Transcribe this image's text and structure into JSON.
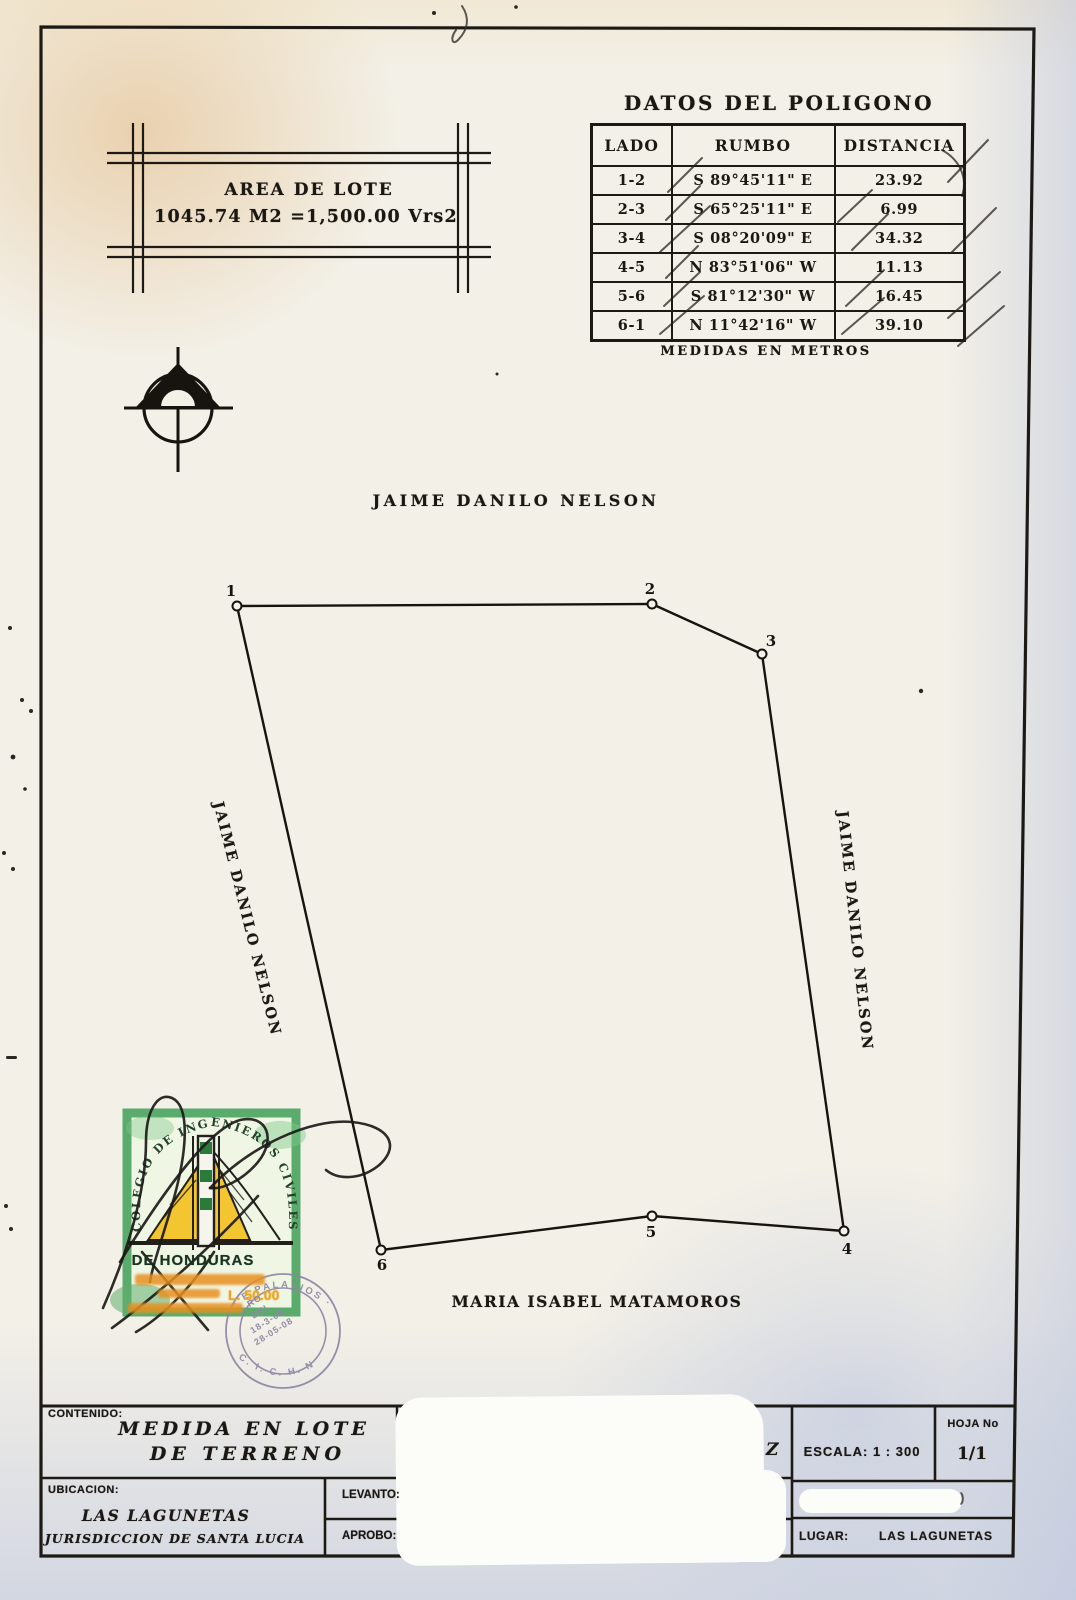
{
  "table": {
    "title": "DATOS DEL POLIGONO",
    "headers": [
      "LADO",
      "RUMBO",
      "DISTANCIA"
    ],
    "rows": [
      {
        "lado": "1-2",
        "rumbo": "S 89°45'11\" E",
        "distancia": "23.92"
      },
      {
        "lado": "2-3",
        "rumbo": "S 65°25'11\" E",
        "distancia": "6.99"
      },
      {
        "lado": "3-4",
        "rumbo": "S 08°20'09\" E",
        "distancia": "34.32"
      },
      {
        "lado": "4-5",
        "rumbo": "N 83°51'06\" W",
        "distancia": "11.13"
      },
      {
        "lado": "5-6",
        "rumbo": "S 81°12'30\" W",
        "distancia": "16.45"
      },
      {
        "lado": "6-1",
        "rumbo": "N 11°42'16\" W",
        "distancia": "39.10"
      }
    ],
    "footnote": "MEDIDAS EN METROS"
  },
  "area_box": {
    "line1": "AREA DE LOTE",
    "line2": "1045.74 M2 =1,500.00 Vrs2"
  },
  "plot": {
    "adjoiners": {
      "top": "JAIME DANILO NELSON",
      "left": "JAIME DANILO NELSON",
      "right": "JAIME DANILO NELSON",
      "bottom": "MARIA ISABEL MATAMOROS"
    },
    "vertices": [
      {
        "id": "1",
        "x": 237,
        "y": 606,
        "dx": -6,
        "dy": -10
      },
      {
        "id": "2",
        "x": 652,
        "y": 604,
        "dx": -2,
        "dy": -10
      },
      {
        "id": "3",
        "x": 762,
        "y": 654,
        "dx": 9,
        "dy": -8
      },
      {
        "id": "4",
        "x": 844,
        "y": 1231,
        "dx": 3,
        "dy": 23
      },
      {
        "id": "5",
        "x": 652,
        "y": 1216,
        "dx": -1,
        "dy": 21
      },
      {
        "id": "6",
        "x": 381,
        "y": 1250,
        "dx": 1,
        "dy": 20
      }
    ]
  },
  "stamp": {
    "arc_text": "COLEGIO DE INGENIEROS CIVILES",
    "line1": "DE HONDURAS",
    "value": "L. 50.00",
    "green": "#3f9f58",
    "yellow": "#f2c531"
  },
  "seal": {
    "rim_top": "· E PALACIOS ·",
    "rim_bottom": "C. I. C. H. N",
    "center_lines": [
      "RO",
      "DEL",
      "18-3-08",
      "28-05-08"
    ],
    "ink": "#8d85a3"
  },
  "title_block": {
    "contenido_label": "CONTENIDO:",
    "contenido_line1": "MEDIDA EN LOTE",
    "contenido_line2": "DE TERRENO",
    "ubicacion_label": "UBICACION:",
    "ubicacion_line1": "LAS LAGUNETAS",
    "ubicacion_line2": "JURISDICCION DE SANTA LUCIA",
    "levanto_label": "LEVANTO:",
    "aprobo_label": "APROBO:",
    "partial_letter": "Z",
    "escala": "ESCALA: 1 : 300",
    "hoja_label": "HOJA No",
    "hoja_value": "1/1",
    "lugar_label": "LUGAR:",
    "lugar_value": "LAS LAGUNETAS",
    "redaction_mark": ")"
  }
}
